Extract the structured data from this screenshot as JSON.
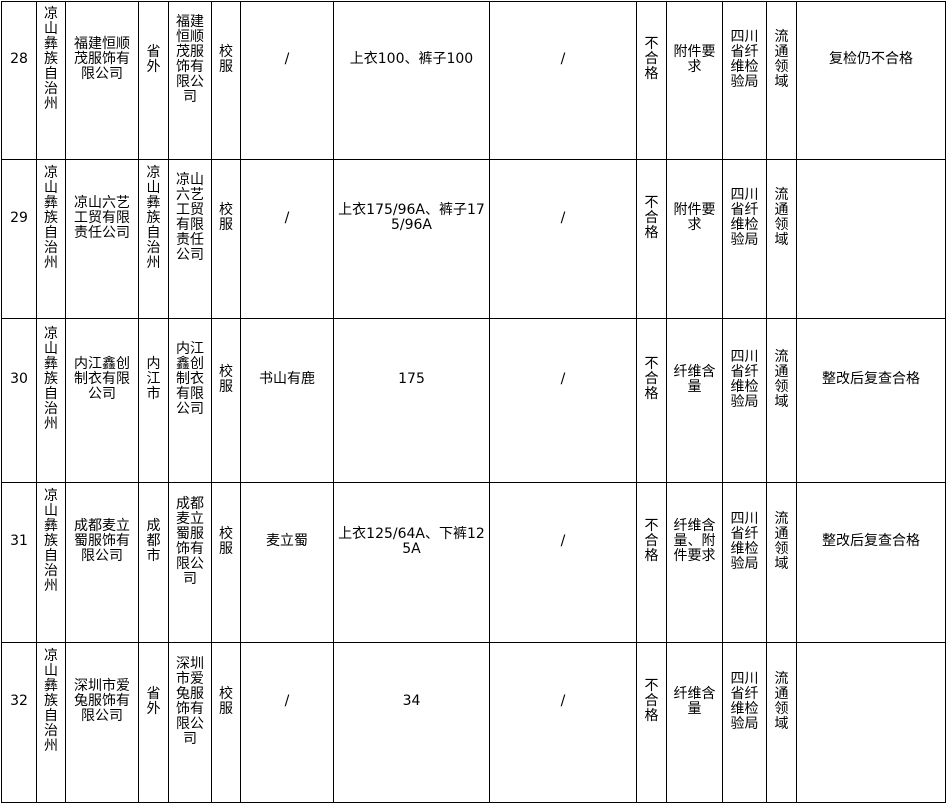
{
  "page": {
    "background_color": "#ffffff",
    "text_color": "#000000",
    "border_color": "#000000"
  },
  "table": {
    "description": "continuation rows 28-32 of an inspection results table, no header row visible",
    "rows": [
      {
        "cells": [
          "28",
          "凉山彝族自治州",
          "福建恒顺茂服饰有限公司",
          "省外",
          "福建恒顺茂服饰有限公司",
          "校服",
          "/",
          "上衣100、裤子100",
          "/",
          "不合格",
          "附件要求",
          "四川省纤维检验局",
          "流通领域",
          "复检仍不合格"
        ]
      },
      {
        "cells": [
          "29",
          "凉山彝族自治州",
          "凉山六艺工贸有限责任公司",
          "凉山彝族自治州",
          "凉山六艺工贸有限责任公司",
          "校服",
          "/",
          "上衣175/96A、裤子175/96A",
          "/",
          "不合格",
          "附件要求",
          "四川省纤维检验局",
          "流通领域",
          ""
        ]
      },
      {
        "cells": [
          "30",
          "凉山彝族自治州",
          "内江鑫创制衣有限公司",
          "内江市",
          "内江鑫创制衣有限公司",
          "校服",
          "书山有鹿",
          "175",
          "/",
          "不合格",
          "纤维含量",
          "四川省纤维检验局",
          "流通领域",
          "整改后复查合格"
        ]
      },
      {
        "cells": [
          "31",
          "凉山彝族自治州",
          "成都麦立蜀服饰有限公司",
          "成都市",
          "成都麦立蜀服饰有限公司",
          "校服",
          "麦立蜀",
          "上衣125/64A、下裤125A",
          "/",
          "不合格",
          "纤维含量、附件要求",
          "四川省纤维检验局",
          "流通领域",
          "整改后复查合格"
        ]
      },
      {
        "cells": [
          "32",
          "凉山彝族自治州",
          "深圳市爱兔服饰有限公司",
          "省外",
          "深圳市爱兔服饰有限公司",
          "校服",
          "/",
          "34",
          "/",
          "不合格",
          "纤维含量",
          "四川省纤维检验局",
          "流通领域",
          ""
        ]
      }
    ]
  }
}
